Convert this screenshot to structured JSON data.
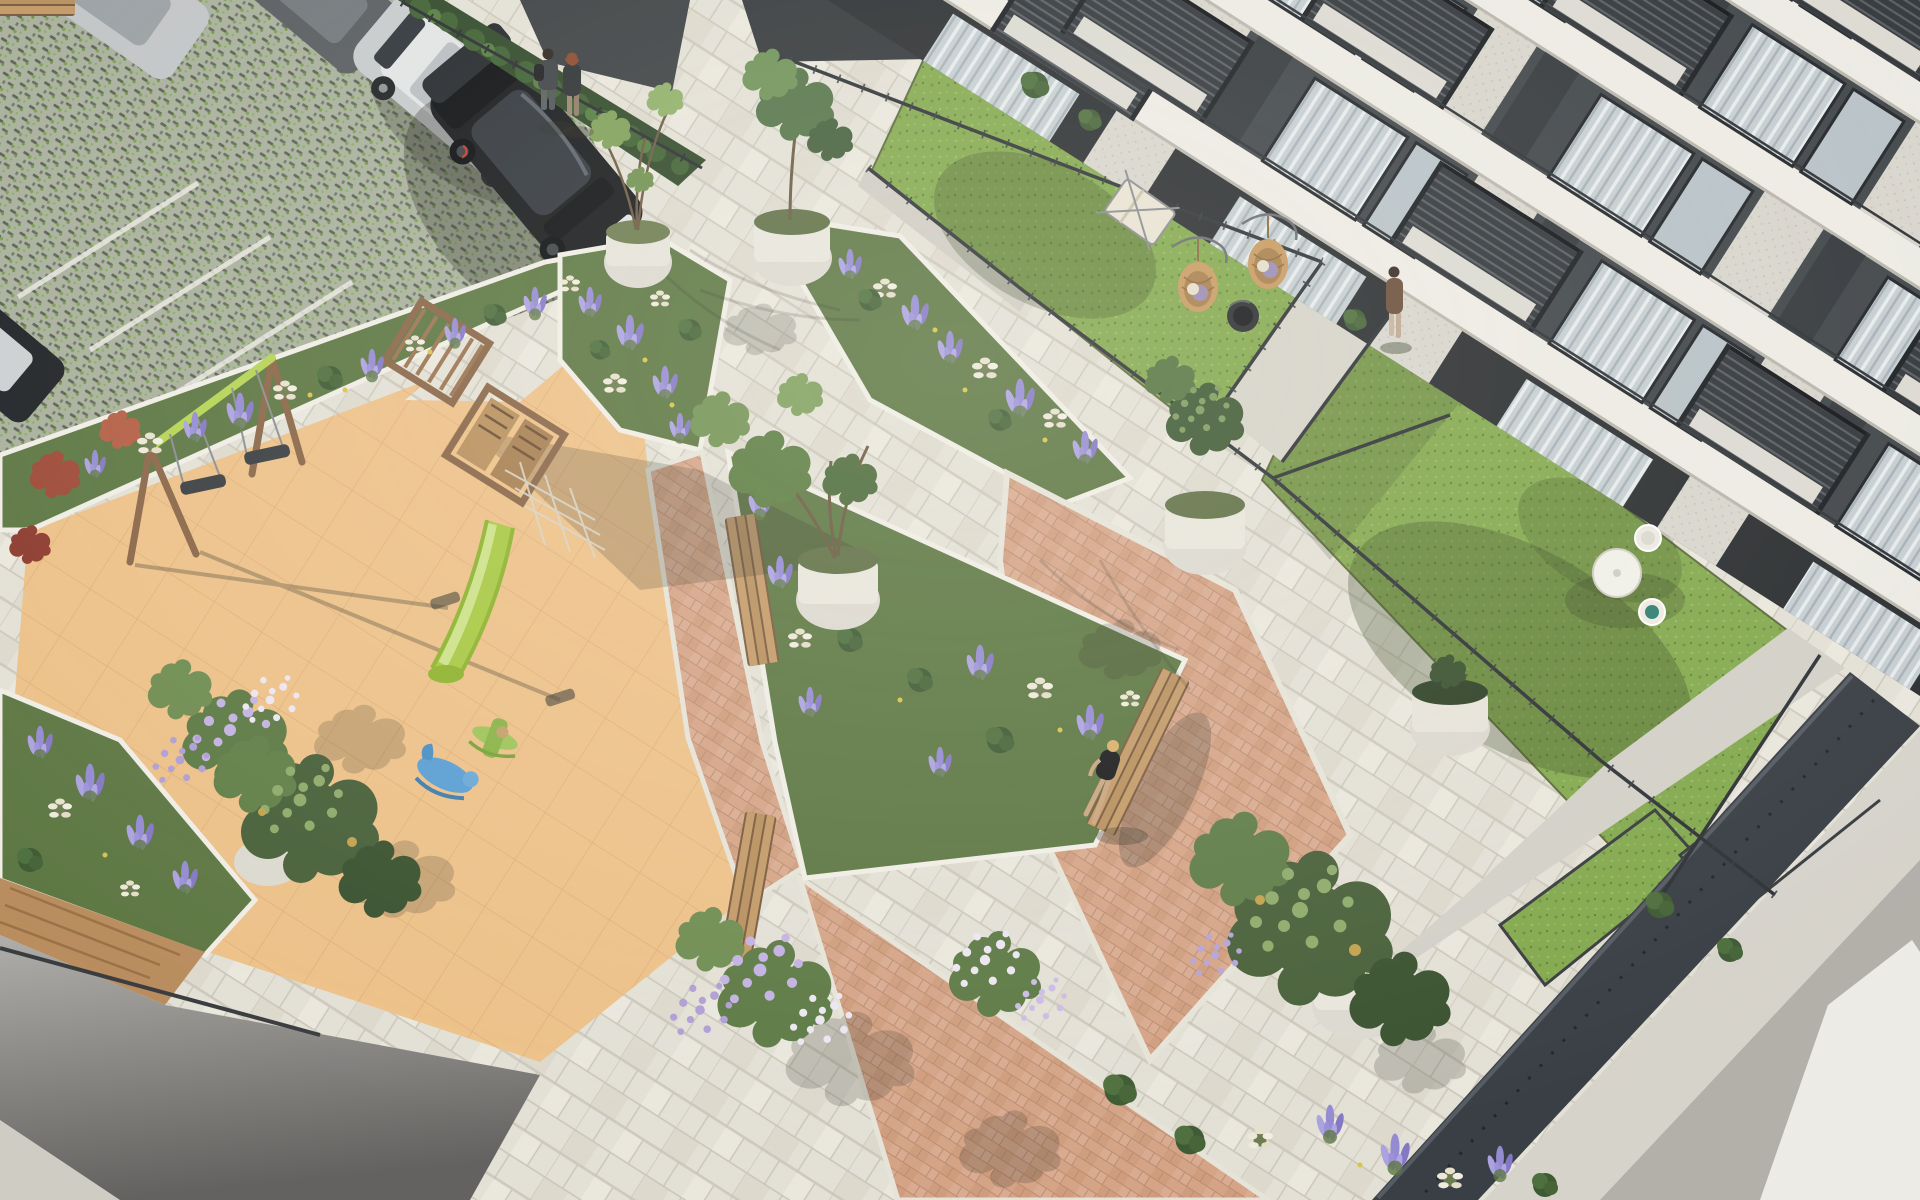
{
  "scene": {
    "type": "aerial architectural rendering",
    "setting": "residential courtyard of an apartment complex, daytime",
    "areas": [
      {
        "name": "parking-lot",
        "surface": "grass-pavers",
        "cars_full": 2,
        "cars_partial": 3,
        "stall_lines": 3
      },
      {
        "name": "entrance-plaza",
        "surface": "stone-paving",
        "people_standing": 2,
        "potted-trees": 2
      },
      {
        "name": "apartment-building",
        "floors_visible": 5,
        "features": [
          "white slab bands",
          "dark slatted balconies",
          "glass doors with curtains",
          "textured concrete piers"
        ]
      },
      {
        "name": "private-lawns",
        "count": 3,
        "furniture": [
          "deck chair",
          "2 hanging egg chairs",
          "fire pit",
          "round table with 2 wire chairs"
        ],
        "person_walking": 1
      },
      {
        "name": "playground",
        "surface": "tan rubber tiles",
        "equipment": [
          "double swing set",
          "climbing towers with pergola",
          "lime slide",
          "climbing net",
          "2 rocking toys"
        ]
      },
      {
        "name": "central-gardens",
        "plants": [
          "lavender",
          "white plume grasses",
          "lilac trees in bloom",
          "magnolia shrubs",
          "red maples"
        ],
        "benches": 3,
        "person_sitting": 1
      },
      {
        "name": "paving",
        "styles": [
          "cream stone",
          "terracotta herringbone triangles"
        ]
      },
      {
        "name": "sunken-patios",
        "features": [
          "dark canopy roof",
          "white walls",
          "small lawns",
          "metal fences"
        ]
      }
    ],
    "people_total": 4
  },
  "palette": {
    "stone": "#e3e0d6",
    "stoneLine": "#c9c5b8",
    "pink": "#d5a487",
    "pinkLine": "#bb8d71",
    "tan": "#edc189",
    "tanLine": "#dcab74",
    "lawn": "#84a94f",
    "lawnDark": "#6d9140",
    "paver": "#a9b09d",
    "paverDark": "#5a6152",
    "paverGreen": "#79a04b",
    "bed": "#5d7743",
    "lavender": "#958bd3",
    "lavenderLight": "#aca2e0",
    "plume": "#ece7d6",
    "building": "#41464a",
    "buildingDark": "#2b2e31",
    "slab": "#edebe4",
    "glass": "#c6ced2",
    "concrete": "#d6d3cb",
    "fence": "#2f3337",
    "wood": "#8a6648",
    "woodLight": "#c39a68",
    "lime": "#b5d455",
    "ramp": "#7a7977",
    "canopy": "#3a3f46",
    "curb": "#efede5"
  }
}
